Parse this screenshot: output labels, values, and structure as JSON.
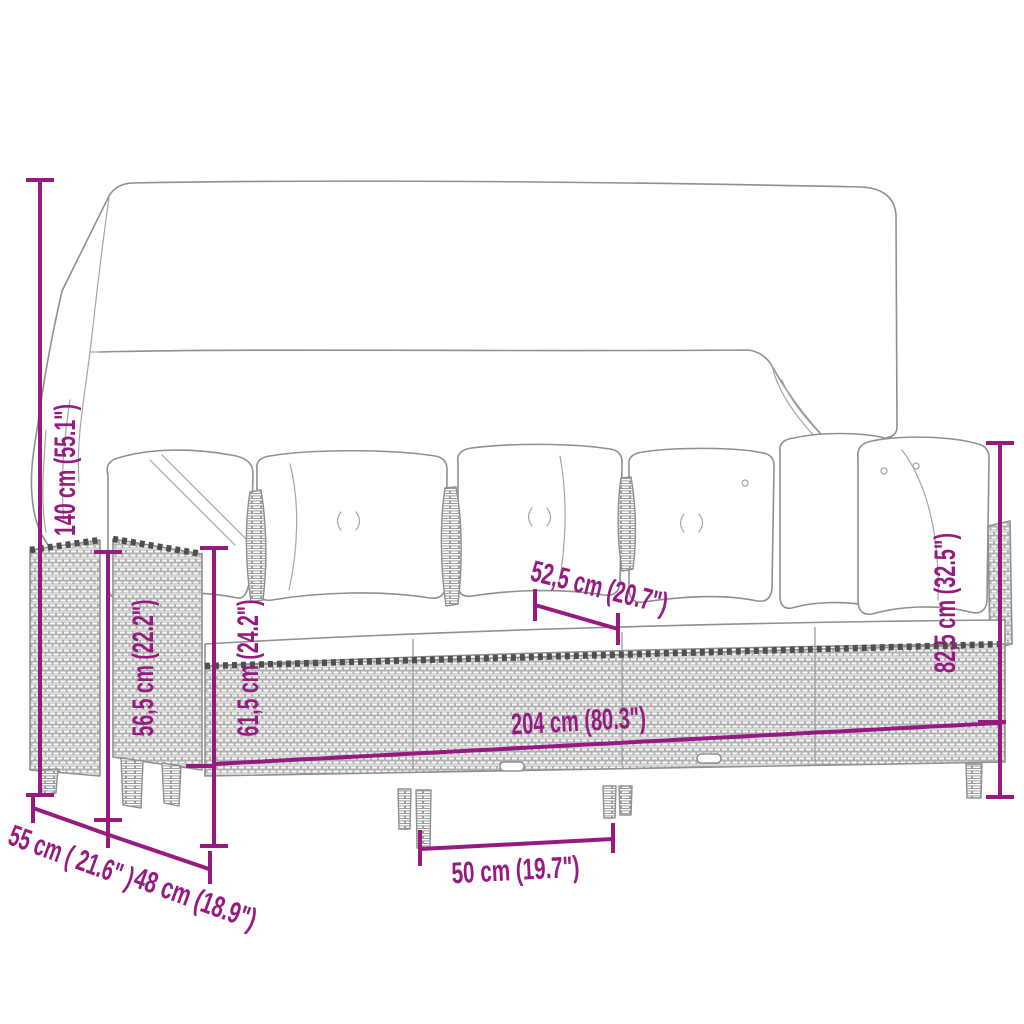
{
  "diagram": {
    "subject": "garden lounge sofa set with canopy - dimension drawing",
    "accent_color": "#951b81",
    "line_color": "#8f8f8f",
    "measurements": [
      {
        "id": "overall-height",
        "label": "140 cm (55.1\")"
      },
      {
        "id": "armrest-height",
        "label": "56,5 cm (22.2\")"
      },
      {
        "id": "frame-height",
        "label": "61,5 cm (24.2\")"
      },
      {
        "id": "seat-section",
        "label": "52,5 cm (20.7\")"
      },
      {
        "id": "backrest-height",
        "label": "82,5 cm (32.5\")"
      },
      {
        "id": "overall-width",
        "label": "204 cm (80.3\")"
      },
      {
        "id": "side-depth",
        "label": "55 cm ( 21.6\" )"
      },
      {
        "id": "module-depth",
        "label": "48 cm (18.9\")"
      },
      {
        "id": "seat-width",
        "label": "50 cm (19.7\")"
      }
    ]
  }
}
